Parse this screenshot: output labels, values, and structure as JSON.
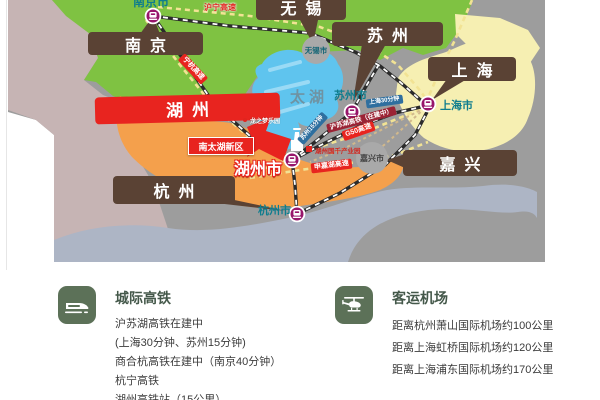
{
  "map": {
    "lake_label": "太湖",
    "cities": {
      "nanjing": {
        "label": "南京",
        "marker": "南京市"
      },
      "wuxi": {
        "label": "无锡",
        "marker": "无锡市"
      },
      "suzhou": {
        "label": "苏州",
        "marker": "苏州市"
      },
      "shanghai": {
        "label": "上海",
        "marker": "上海市"
      },
      "jiaxing": {
        "label": "嘉兴",
        "marker": "嘉兴市"
      },
      "hangzhou": {
        "label": "杭州",
        "marker": "杭州市"
      },
      "huzhou": {
        "label": "湖州",
        "marker": "湖州市"
      }
    },
    "tags": {
      "huning_expwy": "沪宁高速",
      "ninghang_expwy": "宁杭高速",
      "g50_expwy": "G50高速",
      "shenjiahu_expwy": "申嘉湖高速",
      "husuhu_rail": "沪苏湖高铁（在建中）",
      "shanghai_time": "上海30分钟",
      "suzhou_time": "苏州15分钟"
    },
    "pois": {
      "nantaihu_new_district": "南太湖新区",
      "dragon_dream_park": "龙之梦乐园",
      "industry_park": "湖州国千产业园"
    }
  },
  "sections": {
    "rail": {
      "title": "城际高铁",
      "lines": [
        "沪苏湖高铁在建中",
        "(上海30分钟、苏州15分钟)",
        "商合杭高铁在建中（南京40分钟）",
        "杭宁高铁",
        "湖州高铁站（15公里）"
      ]
    },
    "airport": {
      "title": "客运机场",
      "lines": [
        "距离杭州萧山国际机场约100公里",
        "距离上海虹桥国际机场约120公里",
        "距离上海浦东国际机场约170公里"
      ]
    }
  },
  "colors": {
    "highlight_red": "#e8241f",
    "callout_brown": "#5a4234",
    "station_purple": "#97156a",
    "region_green": "#7fc242",
    "region_orange": "#f4a04c",
    "region_mauve": "#c6b4b4",
    "region_yellow": "#f6efb2",
    "region_grayblue": "#adb5c5",
    "lake_blue": "#5fc4ee",
    "section_icon_green": "#5c7158",
    "city_text_teal": "#0f7d8e"
  }
}
